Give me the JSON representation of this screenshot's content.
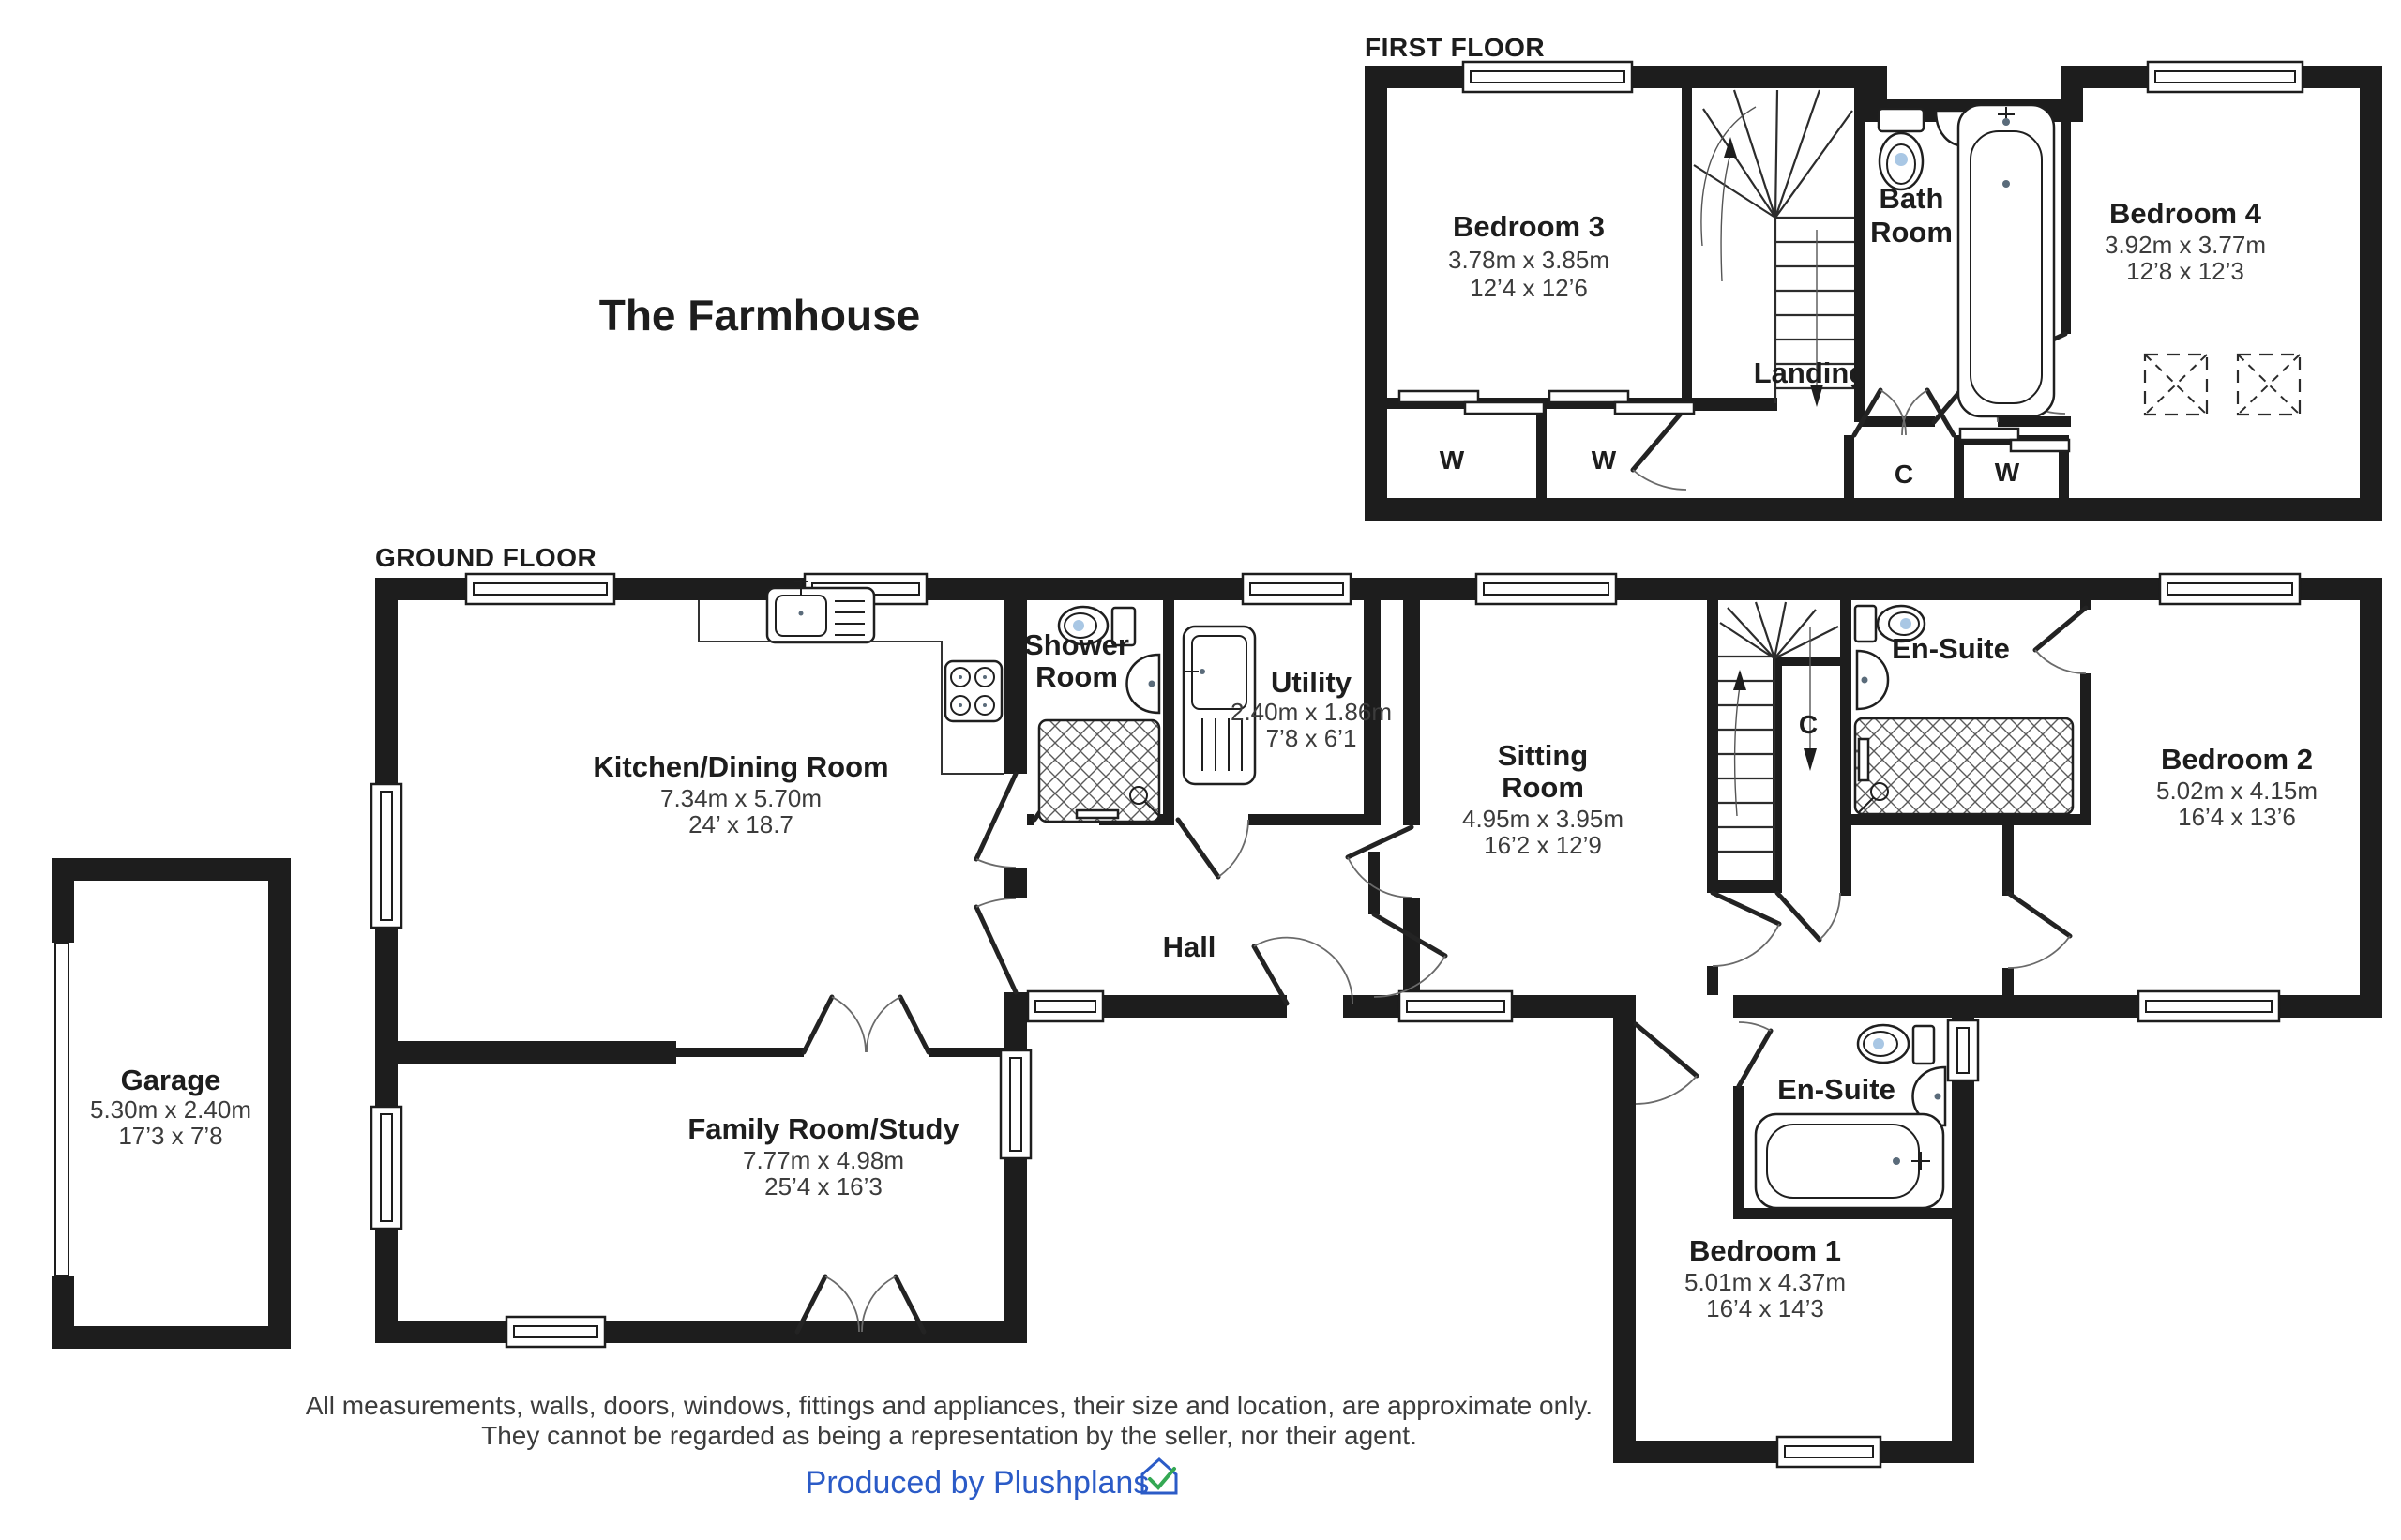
{
  "title": "The Farmhouse",
  "first_floor": {
    "label": "FIRST FLOOR",
    "bedroom3": {
      "name": "Bedroom 3",
      "metric": "3.78m x 3.85m",
      "imperial": "12’4 x 12’6"
    },
    "bathroom": {
      "line1": "Bath",
      "line2": "Room"
    },
    "bedroom4": {
      "name": "Bedroom 4",
      "metric": "3.92m x 3.77m",
      "imperial": "12’8 x 12’3"
    },
    "landing": {
      "name": "Landing"
    },
    "wardrobe1": "W",
    "wardrobe2": "W",
    "cupboard": "C",
    "wardrobe3": "W"
  },
  "ground_floor": {
    "label": "GROUND FLOOR",
    "kitchen": {
      "name": "Kitchen/Dining Room",
      "metric": "7.34m x 5.70m",
      "imperial": "24’ x 18.7"
    },
    "shower_room": {
      "line1": "Shower",
      "line2": "Room"
    },
    "utility": {
      "name": "Utility",
      "metric": "2.40m x 1.86m",
      "imperial": "7’8 x 6’1"
    },
    "sitting_room": {
      "line1": "Sitting",
      "line2": "Room",
      "metric": "4.95m x 3.95m",
      "imperial": "16’2 x 12’9"
    },
    "ensuite_top": {
      "name": "En-Suite"
    },
    "bedroom2": {
      "name": "Bedroom 2",
      "metric": "5.02m x 4.15m",
      "imperial": "16’4 x 13’6"
    },
    "hall": {
      "name": "Hall"
    },
    "cupboard": "C",
    "family_room": {
      "name": "Family Room/Study",
      "metric": "7.77m x 4.98m",
      "imperial": "25’4 x 16’3"
    },
    "ensuite_bottom": {
      "name": "En-Suite"
    },
    "bedroom1": {
      "name": "Bedroom 1",
      "metric": "5.01m x 4.37m",
      "imperial": "16’4 x 14’3"
    },
    "garage": {
      "name": "Garage",
      "metric": "5.30m x 2.40m",
      "imperial": "17’3 x 7’8"
    }
  },
  "disclaimer": {
    "line1": "All measurements, walls, doors, windows, fittings and appliances, their size and location, are approximate only.",
    "line2": "They cannot be regarded as being a representation by the seller, nor their agent."
  },
  "credit": {
    "text": "Produced by Plushplans"
  },
  "colors": {
    "wall": "#1d1d1d",
    "dim_text": "#3c3c3c",
    "credit_blue": "#2b5bc7",
    "logo_green": "#34a853",
    "fixture_blue": "#a9c7e4"
  }
}
